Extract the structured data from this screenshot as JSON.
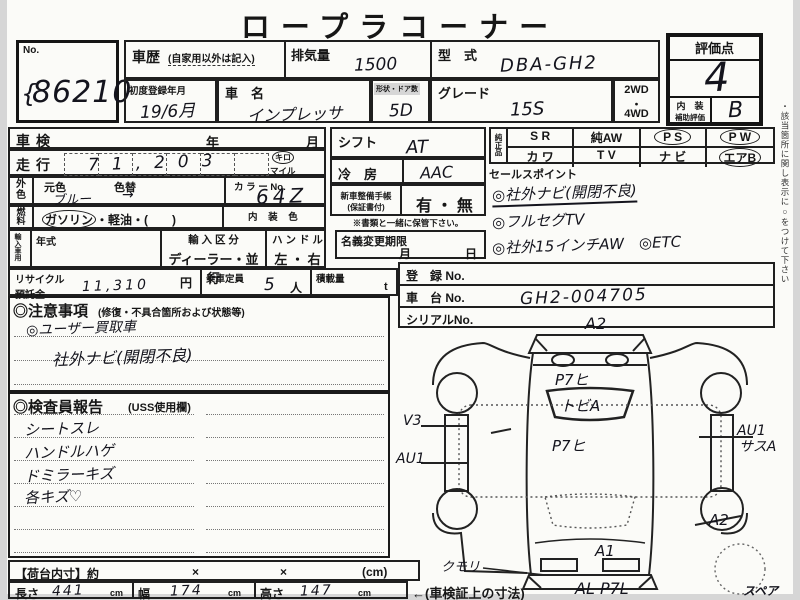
{
  "colors": {
    "ink": "#1b1b1b",
    "paper": "#fbfbf8",
    "scan_edge": "#d6d6d6",
    "handwriting": "#14141d"
  },
  "title": "ロープラコーナー",
  "lot": {
    "label": "No.",
    "value": "86210"
  },
  "row1": {
    "history_label": "車歴",
    "history_note": "(自家用以外は記入)",
    "disp_label": "排気量",
    "disp_value": "1500",
    "model_label": "型　式",
    "model_value": "DBA-GH2",
    "firstreg_label": "初度登録年月",
    "firstreg_value": "19/6月",
    "name_label": "車　名",
    "name_value": "インプレッサ",
    "doors_label": "形状・ドア数",
    "doors_value": "5D",
    "grade_label": "グレード",
    "grade_value": "15S",
    "drive_top": "2WD",
    "drive_dot": "・",
    "drive_bottom": "4WD"
  },
  "score": {
    "label": "評価点",
    "value": "4",
    "interior_label": "内　装",
    "aux_label": "補助評価",
    "interior_value": "B"
  },
  "left": {
    "shaken": "車検",
    "year": "年",
    "month": "月",
    "mileage_label": "走行",
    "mileage_value": "71,203",
    "unit_km": "キロ",
    "unit_mile": "マイル",
    "ext_top": "外",
    "ext_bottom": "色",
    "origcolor": "元色",
    "origcolor_value": "ブルー",
    "colorchange": "色替",
    "colorchange_value": "→",
    "colorno_label": "カ ラ ー No.",
    "colorno_value": "64Z",
    "fuel_top": "燃",
    "fuel_bottom": "料",
    "fuel_gas": "ガソリン",
    "fuel_rest": "・軽油・(　　)",
    "intcolor_label": "内 装 色",
    "import_label": "輸入車用",
    "yeartype": "年式",
    "importclass_label": "輸 入 区 分",
    "importclass_value": "ディーラー・並行",
    "handle_label": "ハ ン ド ル",
    "handle_value": "左 ・ 右",
    "recycle_label1": "リサイクル",
    "recycle_label2": "預託金",
    "recycle_value": "11,310",
    "yen": "円",
    "capacity_label": "乗車定員",
    "capacity_value": "5",
    "capacity_unit": "人",
    "load_label": "積載量",
    "load_unit": "t"
  },
  "mid": {
    "shift_label": "シフト",
    "shift_value": "AT",
    "ac_label": "冷　房",
    "ac_value": "AAC",
    "manual_label1": "新車整備手帳",
    "manual_label2": "(保証書付)",
    "manual_value": "有 ・ 無",
    "keep_note": "※書類と一緒に保管下さい。",
    "transfer_label": "名義変更期限",
    "transfer_month": "月",
    "transfer_day": "日"
  },
  "equip": {
    "label1": "純",
    "label2": "正",
    "label3": "品",
    "r1": [
      "S R",
      "純AW",
      "P S",
      "P W"
    ],
    "r2": [
      "カ ワ",
      "T V",
      "ナ ビ",
      "エアB"
    ]
  },
  "sales": {
    "label": "セールスポイント",
    "line1": "◎社外ナビ(開閉不良)",
    "line2": "◎フルセグTV",
    "line3": "◎社外15インチAW　◎ETC"
  },
  "reg": {
    "reg_label": "登　録 No.",
    "chassis_label": "車　台 No.",
    "chassis_value": "GH2-004705",
    "serial_label": "シリアルNo."
  },
  "notes": {
    "title": "◎注意事項",
    "subtitle": "(修復・不具合箇所および状態等)",
    "line1": "◎ユーザー買取車",
    "line2": "社外ナビ(開閉不良)"
  },
  "inspector": {
    "title": "◎検査員報告",
    "subtitle": "(USS使用欄)",
    "line1": "シートスレ",
    "line2": "ハンドルハゲ",
    "line3": "ドミラーキズ",
    "line4": "各キズ♡"
  },
  "dims": {
    "label": "【荷台内寸】約",
    "x1": "×",
    "x2": "×",
    "unit": "(cm)",
    "len_label": "長さ",
    "len_value": "441",
    "w_label": "幅",
    "w_value": "174",
    "h_label": "高さ",
    "h_value": "147",
    "cm": "cm",
    "note": "←(車検証上の寸法)"
  },
  "diagram": {
    "rear": "A2",
    "gate1": "P7ヒ",
    "gate2": "トビA",
    "roof": "P7ヒ",
    "left1": "V3",
    "left2": "AU1",
    "front": "A1",
    "headlight": "クモリ",
    "bumper": "AL P7L",
    "right1": "AU1",
    "right2": "サスA",
    "right3": "A2",
    "spare": "スペア"
  },
  "side_note": "・該当箇所に関し表示に○をつけて下さい"
}
